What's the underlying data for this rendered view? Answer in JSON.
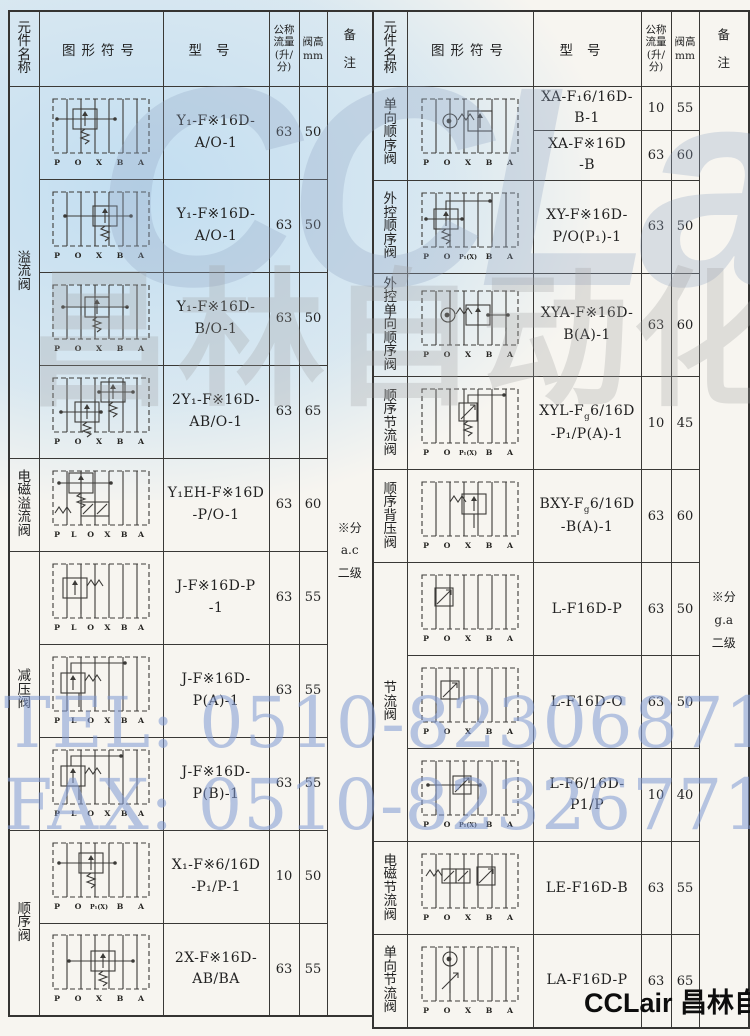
{
  "page": {
    "watermark": {
      "logo": "CCLair",
      "company": "昌林自动化",
      "tel": "TEL: 0510-82306871",
      "fax": "FAX: 0510-82326771"
    },
    "footer_brand": "CCLair 昌林自动化",
    "colors": {
      "tint_blue": "#9ecef2",
      "watermark_blue": "#8099d4",
      "watermark_gray": "#9e9e9e",
      "table_line": "#3a3936",
      "paper": "#f7f5f0"
    }
  },
  "header": {
    "name": "元件名称",
    "symbol": "图形符号",
    "model": "型号",
    "flow": "公称\n流量\n(升/\n分)",
    "height": "阀高\nmm",
    "remark": "备\n注"
  },
  "left": {
    "names": [
      {
        "label": "溢流阀"
      },
      {
        "label": "电磁溢流阀"
      },
      {
        "label": "减压阀"
      },
      {
        "label": "顺序阀"
      }
    ],
    "remark": "※分\na.c\n二级",
    "rows": [
      {
        "model": "Y₁-F※16D-\nA/O-1",
        "flow": "63",
        "height": "50",
        "symbol": "relief-valve",
        "ports": [
          "P",
          "O",
          "X",
          "B",
          "A"
        ]
      },
      {
        "model": "Y₁-F※16D-\nA/O-1",
        "flow": "63",
        "height": "50",
        "symbol": "relief-valve",
        "ports": [
          "P",
          "O",
          "X",
          "B",
          "A"
        ]
      },
      {
        "model": "Y₁-F※16D-\nB/O-1",
        "flow": "63",
        "height": "50",
        "symbol": "relief-valve",
        "ports": [
          "P",
          "O",
          "X",
          "B",
          "A"
        ]
      },
      {
        "model": "2Y₁-F※16D-\nAB/O-1",
        "flow": "63",
        "height": "65",
        "symbol": "dual-relief-valve",
        "ports": [
          "P",
          "O",
          "X",
          "B",
          "A"
        ]
      },
      {
        "model": "Y₁EH-F※16D\n-P/O-1",
        "flow": "63",
        "height": "60",
        "symbol": "solenoid-relief-valve",
        "ports": [
          "P",
          "L",
          "O",
          "X",
          "B",
          "A"
        ]
      },
      {
        "model": "J-F※16D-P\n-1",
        "flow": "63",
        "height": "55",
        "symbol": "reducing-valve",
        "ports": [
          "P",
          "L",
          "O",
          "X",
          "B",
          "A"
        ]
      },
      {
        "model": "J-F※16D-\nP(A)-1",
        "flow": "63",
        "height": "55",
        "symbol": "reducing-valve",
        "ports": [
          "P",
          "L",
          "O",
          "X",
          "B",
          "A"
        ]
      },
      {
        "model": "J-F※16D-\nP(B)-1",
        "flow": "63",
        "height": "55",
        "symbol": "reducing-valve",
        "ports": [
          "P",
          "L",
          "O",
          "X",
          "B",
          "A"
        ]
      },
      {
        "model": "X₁-F※6/16D\n-P₁/P-1",
        "flow": "10",
        "height": "50",
        "symbol": "sequence-valve",
        "ports": [
          "P",
          "O",
          "P₁(X)",
          "B",
          "A"
        ]
      },
      {
        "model": "2X-F※16D-\nAB/BA",
        "flow": "63",
        "height": "55",
        "symbol": "dual-sequence-valve",
        "ports": [
          "P",
          "O",
          "X",
          "B",
          "A"
        ]
      }
    ]
  },
  "right": {
    "names": [
      {
        "label": "单向顺序阀"
      },
      {
        "label": "外控顺序阀"
      },
      {
        "label": "外控单向顺序阀"
      },
      {
        "label": "顺序节流阀"
      },
      {
        "label": "顺序背压阀"
      },
      {
        "label": "节流阀"
      },
      {
        "label": "电磁节流阀"
      },
      {
        "label": "单向节流阀"
      }
    ],
    "remark": "※分\ng.a\n二级",
    "rows": [
      {
        "model": "XA-F₁6/16D-\nB-1",
        "flow": "10",
        "height": "55",
        "symbol": "check-sequence-valve",
        "ports": [
          "P",
          "O",
          "X",
          "B",
          "A"
        ]
      },
      {
        "model": "XA-F※16D\n-B",
        "flow": "63",
        "height": "60"
      },
      {
        "model": "XY-F※16D-\nP/O(P₁)-1",
        "flow": "63",
        "height": "50",
        "symbol": "pilot-sequence-valve",
        "ports": [
          "P",
          "O",
          "P₁(X)",
          "B",
          "A"
        ]
      },
      {
        "model": "XYA-F※16D-\nB(A)-1",
        "flow": "63",
        "height": "60",
        "symbol": "pilot-check-sequence-valve",
        "ports": [
          "P",
          "O",
          "X",
          "B",
          "A"
        ]
      },
      {
        "model": "XYL-F<sub>g</sub>6/16D\n-P₁/P(A)-1",
        "flow": "10",
        "height": "45",
        "symbol": "sequence-throttle-valve",
        "ports": [
          "P",
          "O",
          "P₁(X)",
          "B",
          "A"
        ]
      },
      {
        "model": "BXY-F<sub>g</sub>6/16D\n-B(A)-1",
        "flow": "63",
        "height": "60",
        "symbol": "back-pressure-valve",
        "ports": [
          "P",
          "O",
          "X",
          "B",
          "A"
        ]
      },
      {
        "model": "L-F16D-P",
        "flow": "63",
        "height": "50",
        "symbol": "throttle-valve",
        "ports": [
          "P",
          "O",
          "X",
          "B",
          "A"
        ]
      },
      {
        "model": "L-F16D-O",
        "flow": "63",
        "height": "50",
        "symbol": "throttle-valve",
        "ports": [
          "P",
          "O",
          "X",
          "B",
          "A"
        ]
      },
      {
        "model": "L-F6/16D-\nP1/P",
        "flow": "10",
        "height": "40",
        "symbol": "throttle-valve",
        "ports": [
          "P",
          "O",
          "P₁(X)",
          "B",
          "A"
        ]
      },
      {
        "model": "LE-F16D-B",
        "flow": "63",
        "height": "55",
        "symbol": "solenoid-throttle-valve",
        "ports": [
          "P",
          "O",
          "X",
          "B",
          "A"
        ]
      },
      {
        "model": "LA-F16D-P",
        "flow": "63",
        "height": "65",
        "symbol": "check-throttle-valve",
        "ports": [
          "P",
          "O",
          "X",
          "B",
          "A"
        ]
      }
    ]
  }
}
